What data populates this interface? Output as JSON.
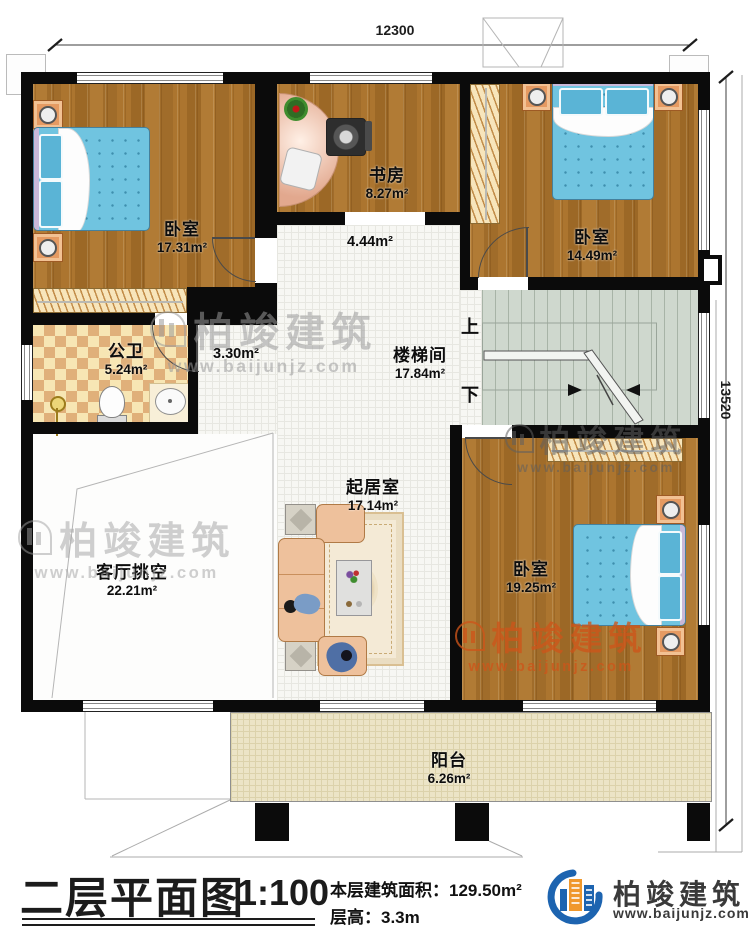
{
  "dimensions": {
    "top": "12300",
    "right": "13520"
  },
  "rooms": [
    {
      "id": "bedroom-nw",
      "name": "卧室",
      "area": "17.31m²"
    },
    {
      "id": "study",
      "name": "书房",
      "area": "8.27m²"
    },
    {
      "id": "bedroom-ne",
      "name": "卧室",
      "area": "14.49m²"
    },
    {
      "id": "hall",
      "name": "",
      "area": "4.44m²"
    },
    {
      "id": "corridor",
      "name": "",
      "area": "3.30m²"
    },
    {
      "id": "bathroom",
      "name": "公卫",
      "area": "5.24m²"
    },
    {
      "id": "stairwell",
      "name": "楼梯间",
      "area": "17.84m²"
    },
    {
      "id": "living-void",
      "name": "客厅挑空",
      "area": "22.21m²"
    },
    {
      "id": "sitting",
      "name": "起居室",
      "area": "17.14m²"
    },
    {
      "id": "bedroom-se",
      "name": "卧室",
      "area": "19.25m²"
    },
    {
      "id": "balcony",
      "name": "阳台",
      "area": "6.26m²"
    }
  ],
  "stairs": {
    "up": "上",
    "down": "下"
  },
  "titleblock": {
    "title": "二层平面图",
    "scale": "1:100",
    "area_label": "本层建筑面积：",
    "area_value": "129.50m²",
    "floor_height_label": "层高：",
    "floor_height_value": "3.3m"
  },
  "brand": {
    "name": "柏竣建筑",
    "url": "www.baijunjz.com"
  },
  "watermark": {
    "text": "柏竣建筑",
    "url": "www.baijunjz.com"
  },
  "colors": {
    "wall": "#0b0b0b",
    "wood_floor": "#a9732f",
    "mattress_blue": "#70c4e0",
    "brand_blue": "#1d64b0",
    "brand_orange": "#f0982c",
    "watermark_orange": "#cd5519"
  }
}
